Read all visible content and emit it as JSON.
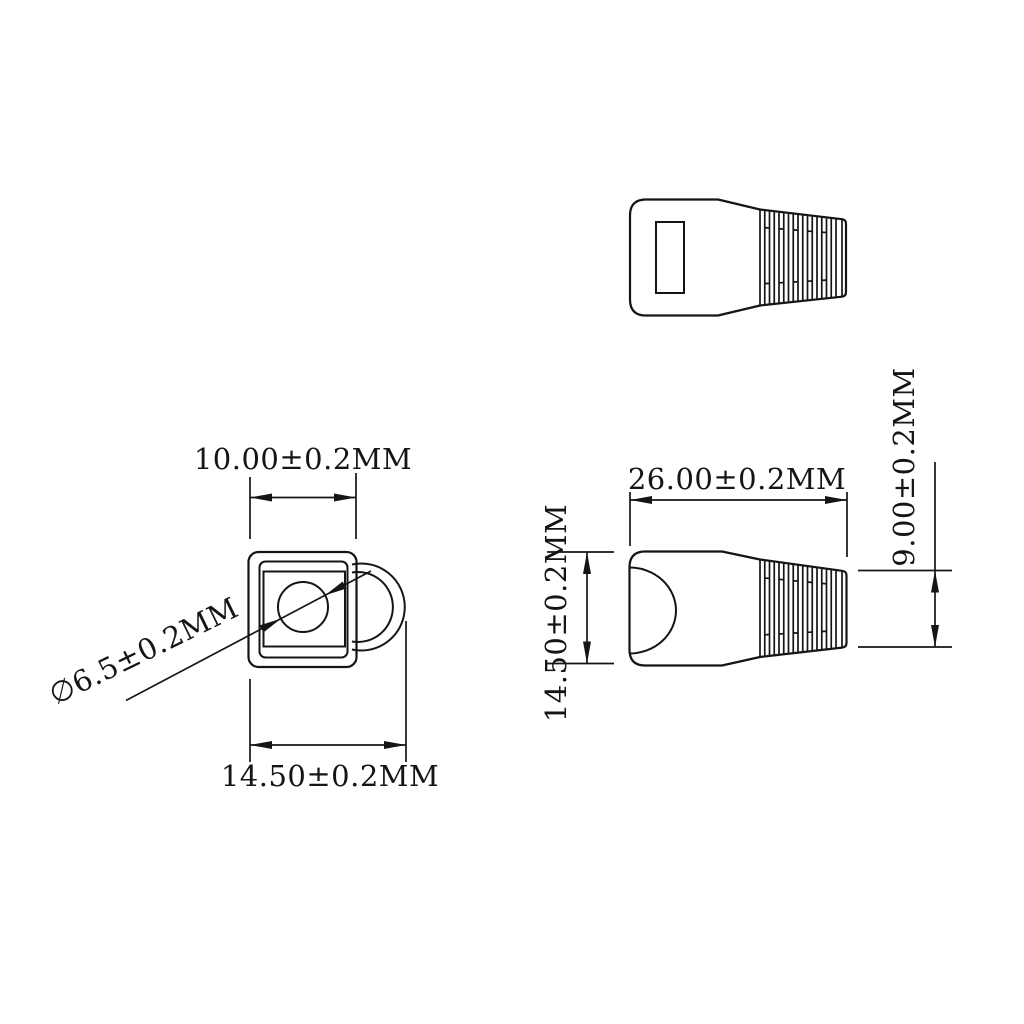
{
  "drawing": {
    "units": "MM",
    "colors": {
      "line": "#151515",
      "background": "#ffffff"
    },
    "end_view": {
      "width_top_label": "10.00±0.2MM",
      "width_overall_label": "14.50±0.2MM",
      "hole_diameter_label": "∅6.5±0.2MM"
    },
    "side_view": {
      "length_label": "26.00±0.2MM",
      "height_label": "14.50±0.2MM",
      "tail_height_label": "9.00±0.2MM"
    }
  }
}
